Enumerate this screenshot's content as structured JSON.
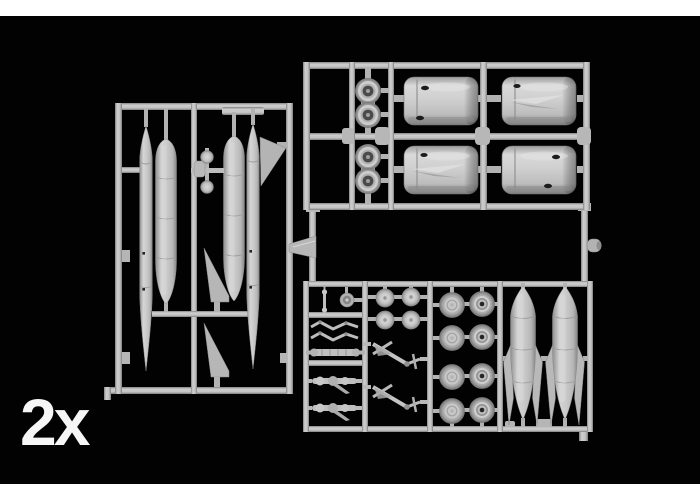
{
  "photo": {
    "quantity_label": "2x",
    "colors": {
      "background": "#000000",
      "top_bottom_bands": "#ffffff",
      "plastic": "#c4c4c4",
      "label_text": "#f6f6f6"
    },
    "sprues": [
      {
        "position": "left",
        "contents": [
          "2 slender fuselage halves",
          "2 wide tank halves",
          "2 swept tail fins",
          "1 delta fin",
          "ball-and-rod assembly"
        ]
      },
      {
        "position": "top-right",
        "contents": [
          "4 engine cowling halves",
          "2 twin-wheel sets"
        ]
      },
      {
        "position": "bottom-right",
        "contents": [
          "8 main wheels",
          "4 small hub wheels",
          "2 landing-gear struts",
          "2 finned drop tanks",
          "small linkages and axles"
        ]
      }
    ]
  }
}
